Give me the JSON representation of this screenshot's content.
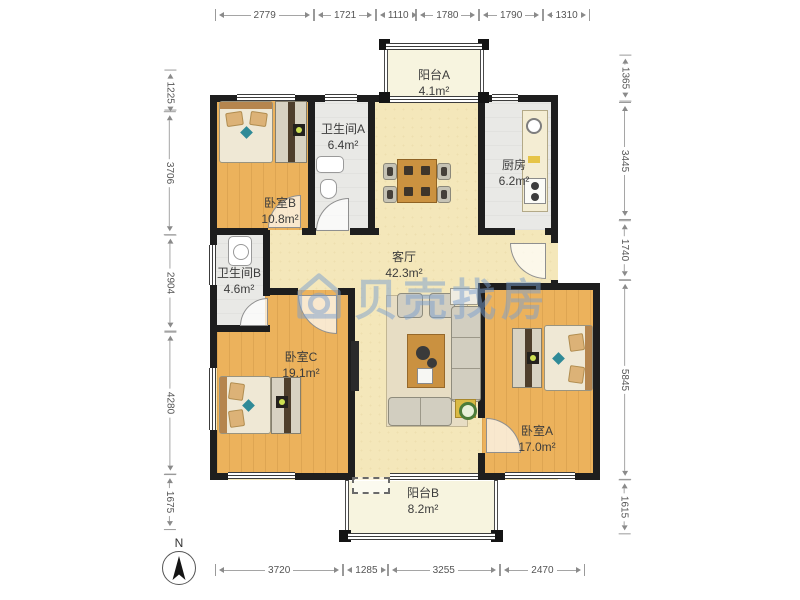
{
  "watermark": {
    "text": "贝壳找房"
  },
  "compass": {
    "label": "N"
  },
  "rooms": [
    {
      "id": "balcony-a",
      "name": "阳台A",
      "area": "4.1m²"
    },
    {
      "id": "bathroom-a",
      "name": "卫生间A",
      "area": "6.4m²"
    },
    {
      "id": "kitchen",
      "name": "厨房",
      "area": "6.2m²"
    },
    {
      "id": "bedroom-b",
      "name": "卧室B",
      "area": "10.8m²"
    },
    {
      "id": "living-room",
      "name": "客厅",
      "area": "42.3m²"
    },
    {
      "id": "bathroom-b",
      "name": "卫生间B",
      "area": "4.6m²"
    },
    {
      "id": "bedroom-c",
      "name": "卧室C",
      "area": "19.1m²"
    },
    {
      "id": "bedroom-a",
      "name": "卧室A",
      "area": "17.0m²"
    },
    {
      "id": "balcony-b",
      "name": "阳台B",
      "area": "8.2m²"
    }
  ],
  "dimensions": {
    "top": [
      "2779",
      "1721",
      "1110",
      "1780",
      "1790",
      "1310"
    ],
    "bottom": [
      "3720",
      "1285",
      "3255",
      "2470"
    ],
    "left": [
      "1225",
      "3706",
      "2904",
      "4280",
      "1675"
    ],
    "right": [
      "1365",
      "3445",
      "1740",
      "5845",
      "1615"
    ]
  }
}
